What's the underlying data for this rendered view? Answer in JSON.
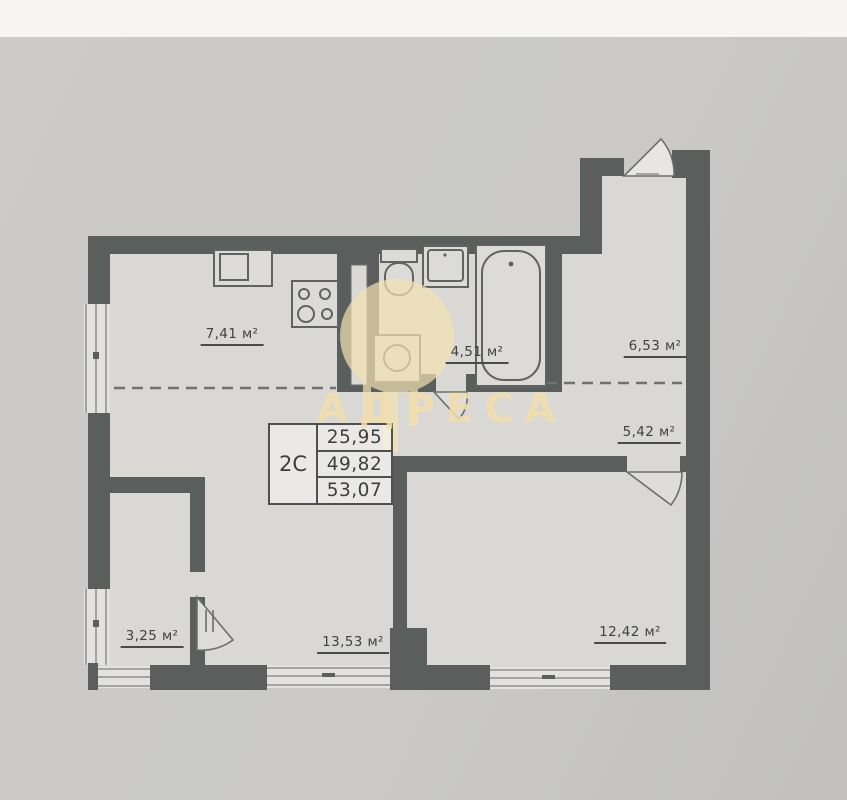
{
  "photo": {
    "top_band_color": "#f7f5f1",
    "background_color": "#cac9c6"
  },
  "watermark": {
    "text": "АДРЕСА",
    "color": "#f3deac",
    "logo": "building-columns-icon"
  },
  "info_box": {
    "type_label": "2С",
    "values": [
      "25,95",
      "49,82",
      "53,07"
    ]
  },
  "rooms": [
    {
      "name": "kitchen",
      "area_label": "7,41 м²"
    },
    {
      "name": "bathroom",
      "area_label": "4,51 м²"
    },
    {
      "name": "entrance-hall",
      "area_label": "6,53 м²"
    },
    {
      "name": "wardrobe",
      "area_label": "5,42 м²"
    },
    {
      "name": "storage",
      "area_label": "3,25 м²"
    },
    {
      "name": "living-room",
      "area_label": "13,53 м²"
    },
    {
      "name": "bedroom",
      "area_label": "12,42 м²"
    }
  ],
  "colors": {
    "walls": "#5a5f5d",
    "room_fill": "#d9d8d5",
    "label_text": "#3f4342"
  }
}
